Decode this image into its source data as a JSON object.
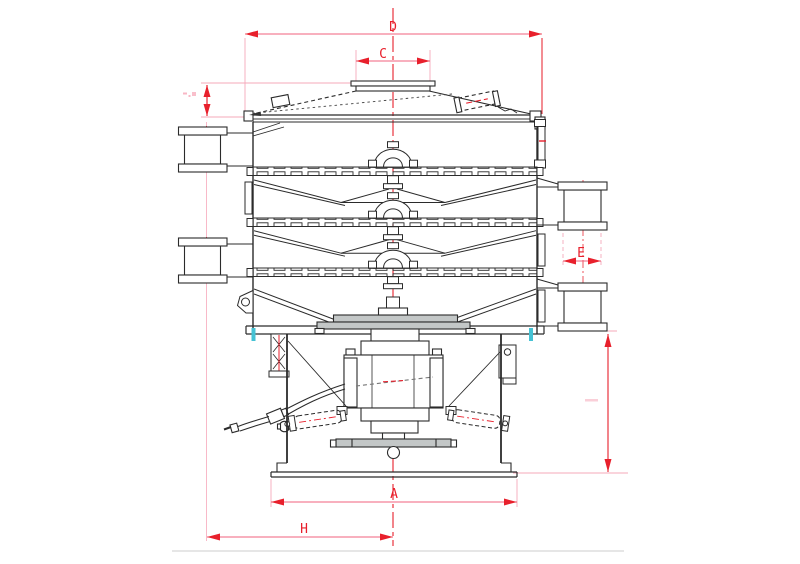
{
  "drawing": {
    "type": "engineering side-elevation of a multi-deck rotary vibrating sieve",
    "labels": {
      "d": "D",
      "c": "C",
      "e": "E",
      "a": "A",
      "h": "H"
    },
    "colors": {
      "dimension_red": "#e8202c",
      "dimension_pink": "#f0607e",
      "extension_pink": "#f6a8ba",
      "drawing_line": "#2b2b2b",
      "clamp_cyan": "#45c2d4",
      "plate_gray": "#c3c7c7",
      "background": "#ffffff"
    }
  }
}
